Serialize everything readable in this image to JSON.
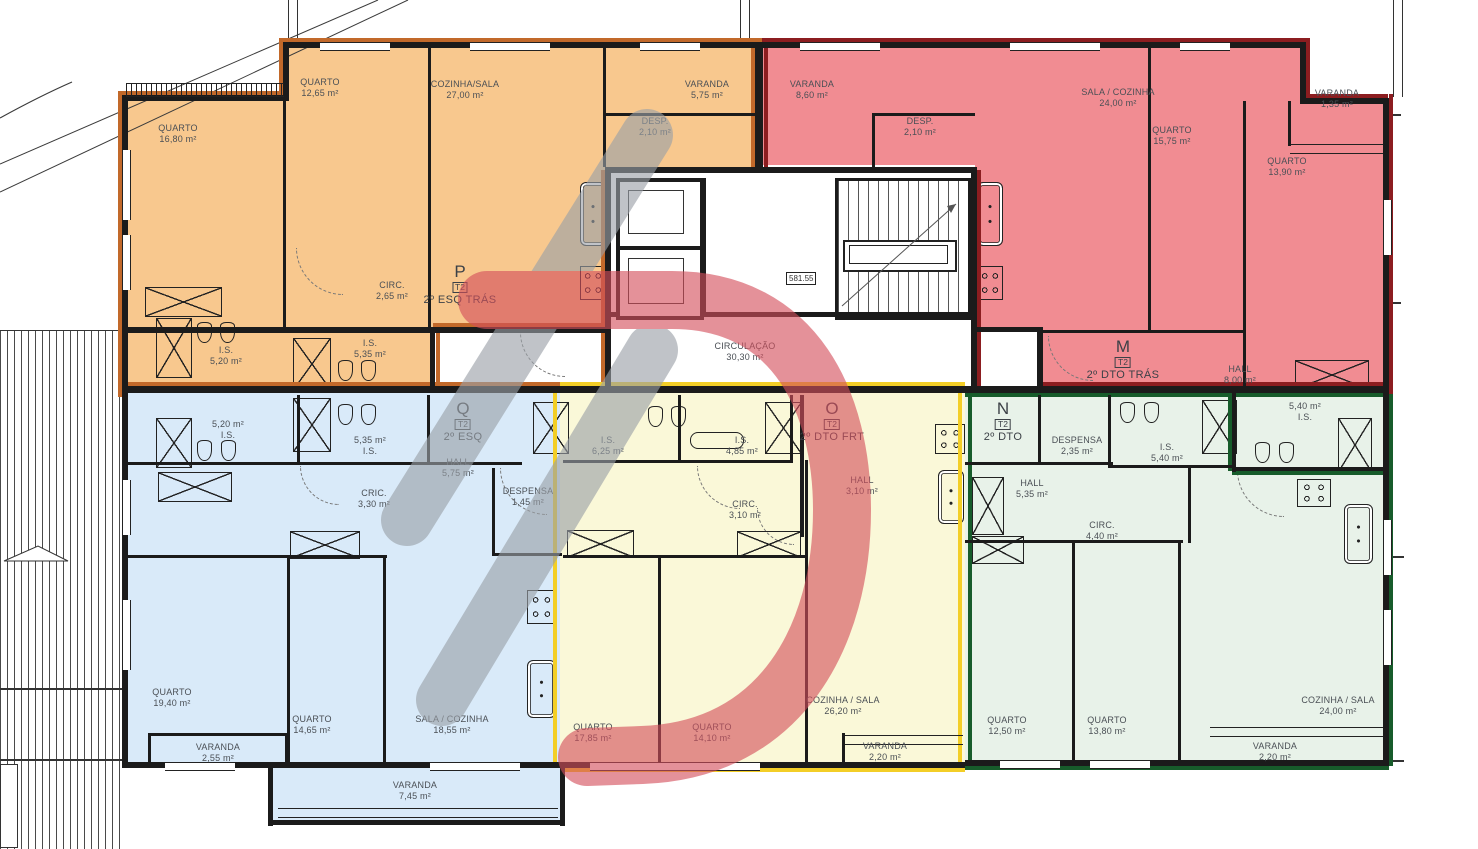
{
  "apartments": [
    {
      "code": "P",
      "type": "T2",
      "unit": "2º ESQ TRÁS",
      "fill": "#f8c88e",
      "outline": "#c2692a",
      "rooms": [
        {
          "name": "QUARTO",
          "area": "16,80 m²"
        },
        {
          "name": "QUARTO",
          "area": "12,65 m²"
        },
        {
          "name": "COZINHA/SALA",
          "area": "27,00 m²"
        },
        {
          "name": "VARANDA",
          "area": "5,75 m²"
        },
        {
          "name": "DESP.",
          "area": "2,10 m²"
        },
        {
          "name": "CIRC.",
          "area": "2,65 m²"
        },
        {
          "name": "I.S.",
          "area": "5,20 m²"
        },
        {
          "name": "I.S.",
          "area": "5,35 m²"
        }
      ]
    },
    {
      "code": "M",
      "type": "T2",
      "unit": "2º DTO TRÁS",
      "fill": "#f18c92",
      "outline": "#8c1d20",
      "rooms": [
        {
          "name": "VARANDA",
          "area": "8,60 m²"
        },
        {
          "name": "DESP.",
          "area": "2,10 m²"
        },
        {
          "name": "SALA / COZINHA",
          "area": "24,00 m²"
        },
        {
          "name": "QUARTO",
          "area": "15,75 m²"
        },
        {
          "name": "QUARTO",
          "area": "13,90 m²"
        },
        {
          "name": "VARANDA",
          "area": "1,35 m²"
        },
        {
          "name": "HALL",
          "area": "8,00 m²"
        },
        {
          "name": "I.S.",
          "area": "5,40 m²"
        }
      ]
    },
    {
      "code": "Q",
      "type": "T2",
      "unit": "2º ESQ",
      "fill": "#d9eaf9",
      "outline": "#1b1b1b",
      "rooms": [
        {
          "name": "I.S.",
          "area": "5,20 m²"
        },
        {
          "name": "I.S.",
          "area": "5,35 m²"
        },
        {
          "name": "HALL",
          "area": "5,75 m²"
        },
        {
          "name": "CRIC.",
          "area": "3,30 m²"
        },
        {
          "name": "DESPENSA",
          "area": "1,45 m²"
        },
        {
          "name": "QUARTO",
          "area": "19,40 m²"
        },
        {
          "name": "QUARTO",
          "area": "14,65 m²"
        },
        {
          "name": "SALA / COZINHA",
          "area": "18,55 m²"
        },
        {
          "name": "VARANDA",
          "area": "2,55 m²"
        },
        {
          "name": "VARANDA",
          "area": "7,45 m²"
        }
      ]
    },
    {
      "code": "O",
      "type": "T2",
      "unit": "2º DTO FRT",
      "fill": "#faf8d8",
      "outline": "#f3ce27",
      "rooms": [
        {
          "name": "I.S.",
          "area": "6,25 m²"
        },
        {
          "name": "I.S.",
          "area": "4,85 m²"
        },
        {
          "name": "CIRC.",
          "area": "3,10 m²"
        },
        {
          "name": "HALL",
          "area": "3,10 m²"
        },
        {
          "name": "QUARTO",
          "area": "17,85 m²"
        },
        {
          "name": "QUARTO",
          "area": "14,10 m²"
        },
        {
          "name": "COZINHA / SALA",
          "area": "26,20 m²"
        },
        {
          "name": "VARANDA",
          "area": "2,20 m²"
        }
      ]
    },
    {
      "code": "N",
      "type": "T2",
      "unit": "2º DTO",
      "fill": "#e8f2e9",
      "outline": "#175c2b",
      "rooms": [
        {
          "name": "DESPENSA",
          "area": "2,35 m²"
        },
        {
          "name": "I.S.",
          "area": "5,40 m²"
        },
        {
          "name": "HALL",
          "area": "5,35 m²"
        },
        {
          "name": "CIRC.",
          "area": "4,40 m²"
        },
        {
          "name": "QUARTO",
          "area": "12,50 m²"
        },
        {
          "name": "QUARTO",
          "area": "13,80 m²"
        },
        {
          "name": "COZINHA / SALA",
          "area": "24,00 m²"
        },
        {
          "name": "VARANDA",
          "area": "2,20 m²"
        }
      ]
    }
  ],
  "common": {
    "circulation_name": "CIRCULAÇÃO",
    "circulation_area": "30,30 m²",
    "stair_level": "581.55"
  },
  "watermark_colors": {
    "gray": "#9aa0a7",
    "red": "#d44f5c"
  }
}
